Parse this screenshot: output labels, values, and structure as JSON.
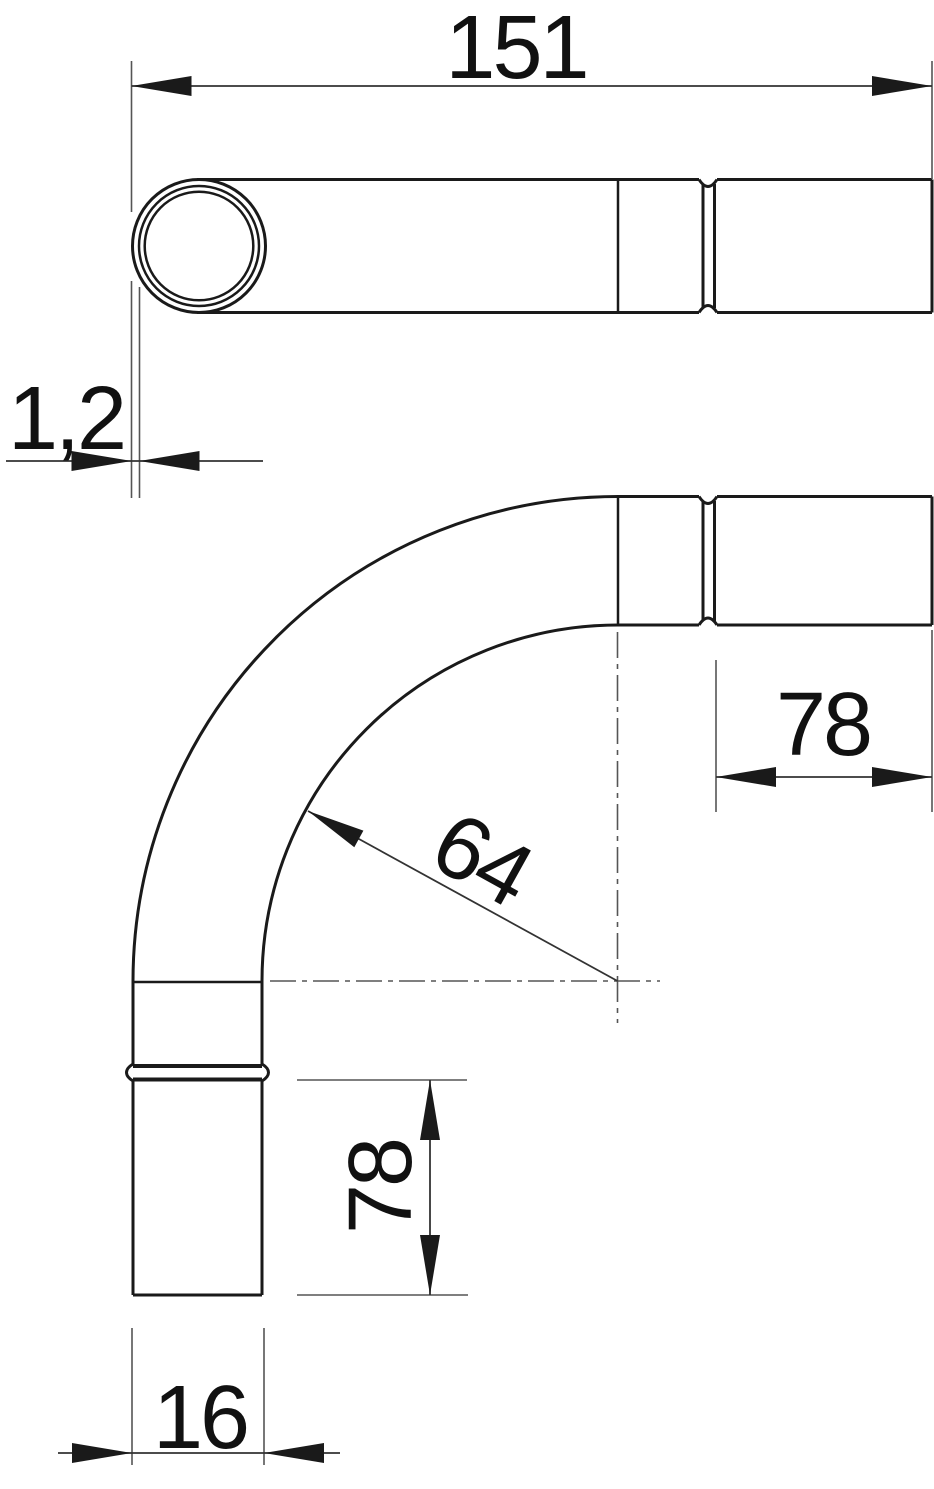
{
  "dimensions": {
    "overall_length": "151",
    "wall_thickness": "1,2",
    "socket_end_length": "78",
    "bend_radius": "64",
    "straight_end_length": "78",
    "outer_diameter": "16"
  },
  "colors": {
    "object_line": "#1a1a1a",
    "thin_line": "#555555",
    "dimension_line": "#333333",
    "background": "#ffffff"
  }
}
